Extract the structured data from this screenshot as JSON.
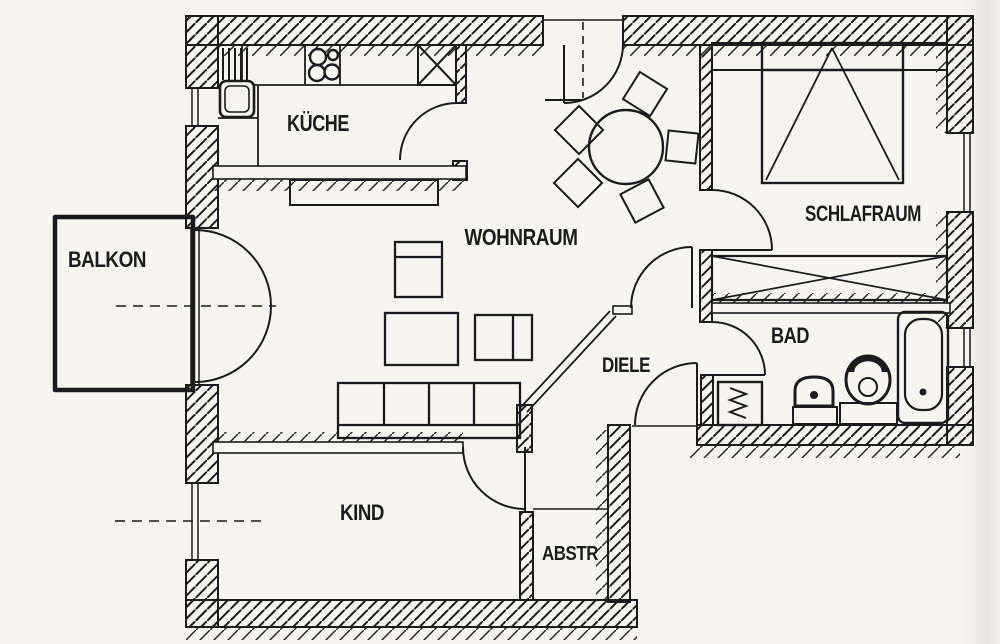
{
  "colors": {
    "ink": "#1b1b1b",
    "paper": "#f7f5ef"
  },
  "rooms": {
    "balkon": {
      "label": "BALKON"
    },
    "kueche": {
      "label": "KÜCHE"
    },
    "wohnraum": {
      "label": "WOHNRAUM"
    },
    "schlafraum": {
      "label": "SCHLAFRAUM"
    },
    "bad": {
      "label": "BAD"
    },
    "diele": {
      "label": "DIELE"
    },
    "kind": {
      "label": "KIND"
    },
    "abstr": {
      "label": "ABSTR"
    }
  },
  "fixtures": {
    "kitchen": {
      "sink": "sink-icon",
      "stove": "stove-burners-icon",
      "dish_rack": "dish-rack-icon",
      "shaft": "shaft-x-icon"
    },
    "living": {
      "sofa": "sofa-icon",
      "table": "table-icon",
      "armchairs": "armchair-icon",
      "dining_table": "round-table-icon",
      "dining_chairs": "chair-icon"
    },
    "bedroom": {
      "bed": "double-bed-icon",
      "wardrobe": "wardrobe-x-icon",
      "nightstands": "nightstand-icon"
    },
    "bathroom": {
      "washing_machine": "washing-machine-icon",
      "washbasin": "washbasin-icon",
      "toilet": "toilet-icon",
      "bathtub": "bathtub-icon"
    }
  }
}
